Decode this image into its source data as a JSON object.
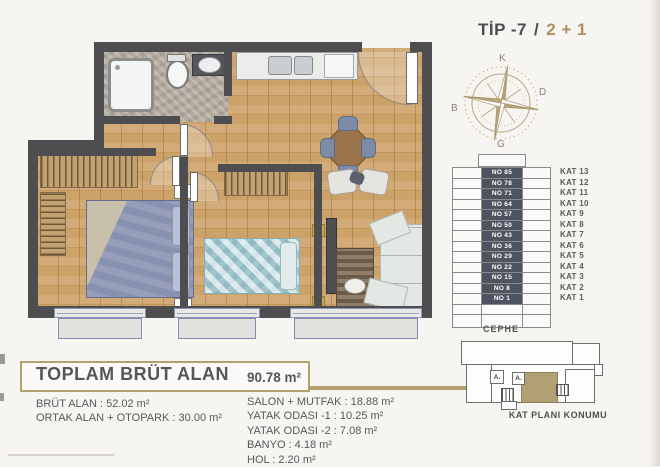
{
  "title": {
    "type_label": "TİP -7",
    "separator": "/",
    "unit_label": "2 + 1"
  },
  "compass": {
    "north": "K",
    "east": "D",
    "west": "B",
    "south": "G"
  },
  "building": {
    "facade_label": "CEPHE",
    "floors": [
      {
        "no": "NO 85",
        "kat": "KAT 13"
      },
      {
        "no": "NO 78",
        "kat": "KAT 12"
      },
      {
        "no": "NO 71",
        "kat": "KAT 11"
      },
      {
        "no": "NO 64",
        "kat": "KAT 10"
      },
      {
        "no": "NO 57",
        "kat": "KAT 9"
      },
      {
        "no": "NO 50",
        "kat": "KAT 8"
      },
      {
        "no": "NO 43",
        "kat": "KAT 7"
      },
      {
        "no": "NO 36",
        "kat": "KAT 6"
      },
      {
        "no": "NO 29",
        "kat": "KAT 5"
      },
      {
        "no": "NO 22",
        "kat": "KAT 4"
      },
      {
        "no": "NO 15",
        "kat": "KAT 3"
      },
      {
        "no": "NO 8",
        "kat": "KAT 2"
      },
      {
        "no": "NO 1",
        "kat": "KAT 1"
      }
    ]
  },
  "location": {
    "label": "KAT PLANI KONUMU",
    "room_labels": [
      "A.",
      "A."
    ]
  },
  "summary": {
    "title": "TOPLAM BRÜT ALAN",
    "value": "90.78 m²"
  },
  "areas_left": [
    "BRÜT ALAN : 52.02 m²",
    "ORTAK ALAN + OTOPARK : 30.00 m²"
  ],
  "areas_right": [
    "SALON + MUTFAK : 18.88 m²",
    "YATAK ODASI -1 : 10.25 m²",
    "YATAK ODASI -2 : 7.08 m²",
    "BANYO : 4.18 m²",
    "HOL : 2.20 m²"
  ],
  "colors": {
    "accent_tan": "#b2a06e",
    "wall": "#4e4e50",
    "wood_floor": "#cda269",
    "unit_highlight": "#b0a073",
    "no_cell_bg": "#4d5360",
    "unit_label_color": "#b08d5e"
  }
}
